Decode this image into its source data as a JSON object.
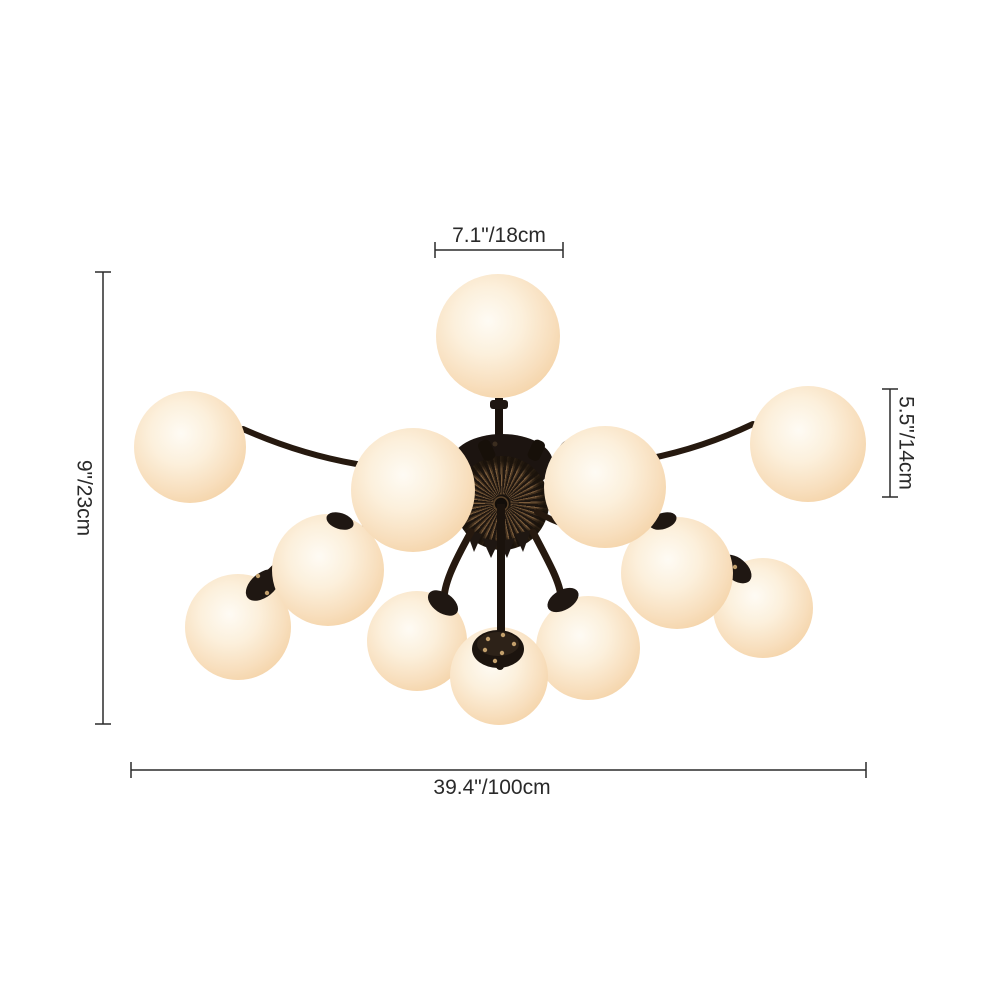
{
  "diagram": {
    "background": "#ffffff",
    "description": "Dimension diagram of a 12-light sputnik flush-mount chandelier with cream frosted glass globes and dark bronze hardware",
    "globe_count": 12,
    "colors": {
      "globe_glass_center": "#fefbf4",
      "globe_glass_edge": "#f3d0a2",
      "metal_dark": "#211712",
      "metal_bronze": "#7b5c3c",
      "dimension_lines": "#2b2b2b"
    },
    "dimension_labels": {
      "top": "7.1\"/18cm",
      "left": "9\"/23cm",
      "right": "5.5\"/14cm",
      "bottom": "39.4\"/100cm"
    }
  }
}
